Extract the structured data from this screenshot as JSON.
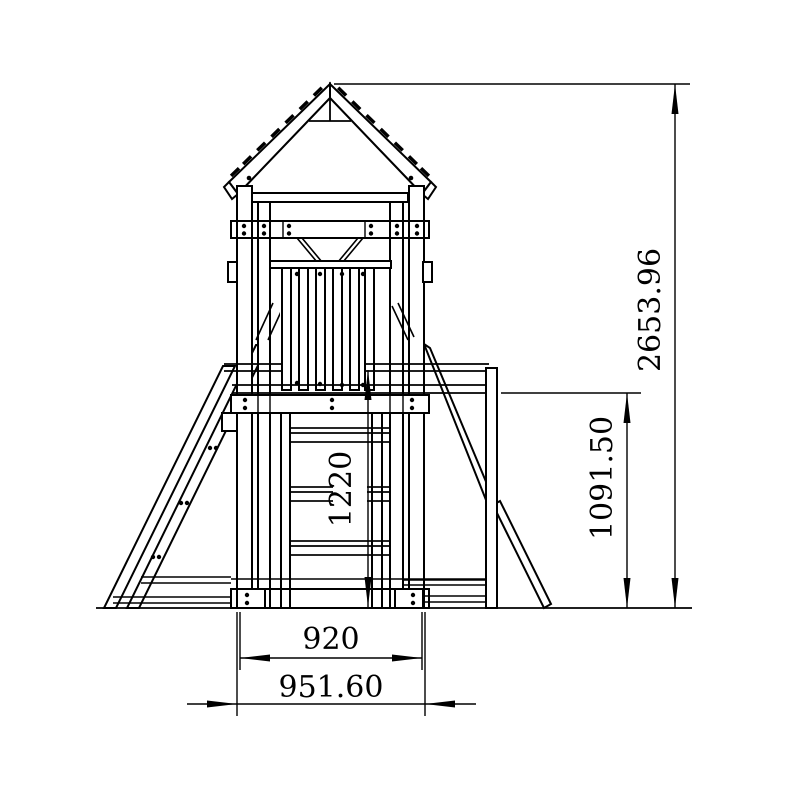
{
  "drawing": {
    "background_color": "#ffffff",
    "line_color": "#000000",
    "view": "front elevation",
    "dimensions": {
      "total_height": {
        "value": "2653.96",
        "orientation": "vertical"
      },
      "platform_height": {
        "value": "1091.50",
        "orientation": "vertical"
      },
      "ladder_height": {
        "value": "1220",
        "orientation": "vertical"
      },
      "inner_width": {
        "value": "920",
        "orientation": "horizontal"
      },
      "outer_width": {
        "value": "951.60",
        "orientation": "horizontal"
      }
    }
  }
}
